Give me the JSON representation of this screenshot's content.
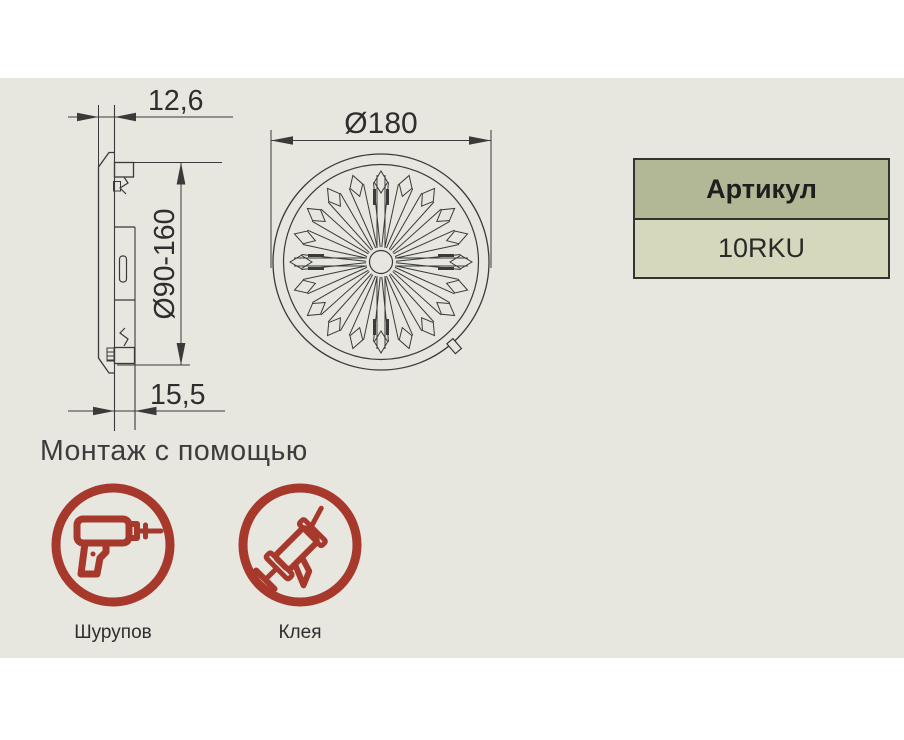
{
  "palette": {
    "background_gray": "#e7e6df",
    "line_color": "#3a3a3a",
    "accent_red": "#a6392c",
    "table_header_bg": "#b2b795",
    "table_value_bg": "#d5d8bc",
    "table_border": "#33332f"
  },
  "drawing": {
    "dim_side_width": "12,6",
    "dim_side_diameter": "Ø90-160",
    "dim_side_depth": "15,5",
    "dim_front_diameter": "Ø180"
  },
  "article_table": {
    "header": "Артикул",
    "value": "10RKU"
  },
  "mounting": {
    "title": "Монтаж с помощью",
    "methods": [
      {
        "icon": "drill-icon",
        "label": "Шурупов"
      },
      {
        "icon": "caulk-gun-icon",
        "label": "Клея"
      }
    ]
  }
}
